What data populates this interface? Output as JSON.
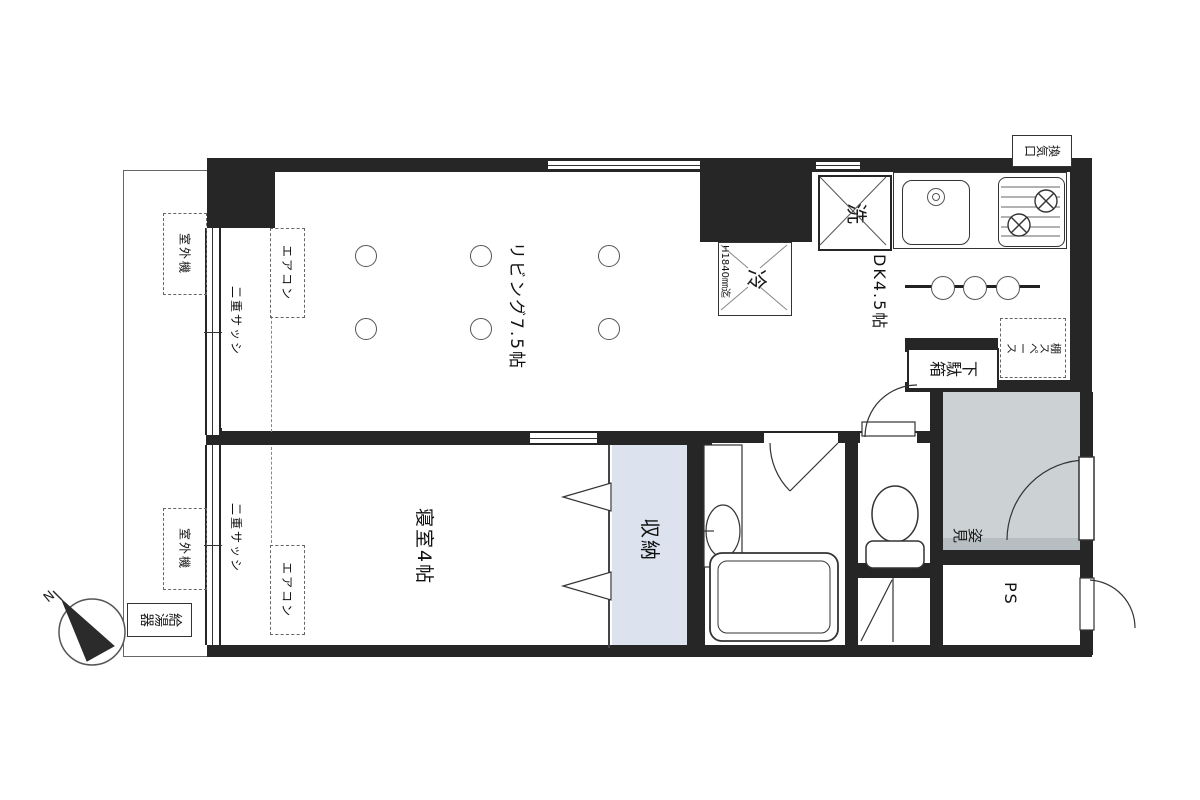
{
  "labels": {
    "living": "リビング7.5帖",
    "dk": "DK4.5帖",
    "bedroom": "寝室4帖",
    "closet": "収納",
    "washer": "洗",
    "fridge": "冷",
    "fridge_note": "H1840㎜迄",
    "vent": "換気口",
    "shoe_box": "下駄箱",
    "shelf_space": "棚スペース",
    "tub": "W1115",
    "mirror": "姿見",
    "ps": "PS",
    "aircon": "エアコン",
    "double_sash": "二重サッシ",
    "outdoor_unit": "室外機",
    "water_heater": "給湯器"
  },
  "compass": {
    "n": "N"
  },
  "colors": {
    "wall": "#262626",
    "closet_fill": "#dce3ee",
    "entry_fill": "#ccd1d3",
    "entry_step": "#b7bec1"
  }
}
